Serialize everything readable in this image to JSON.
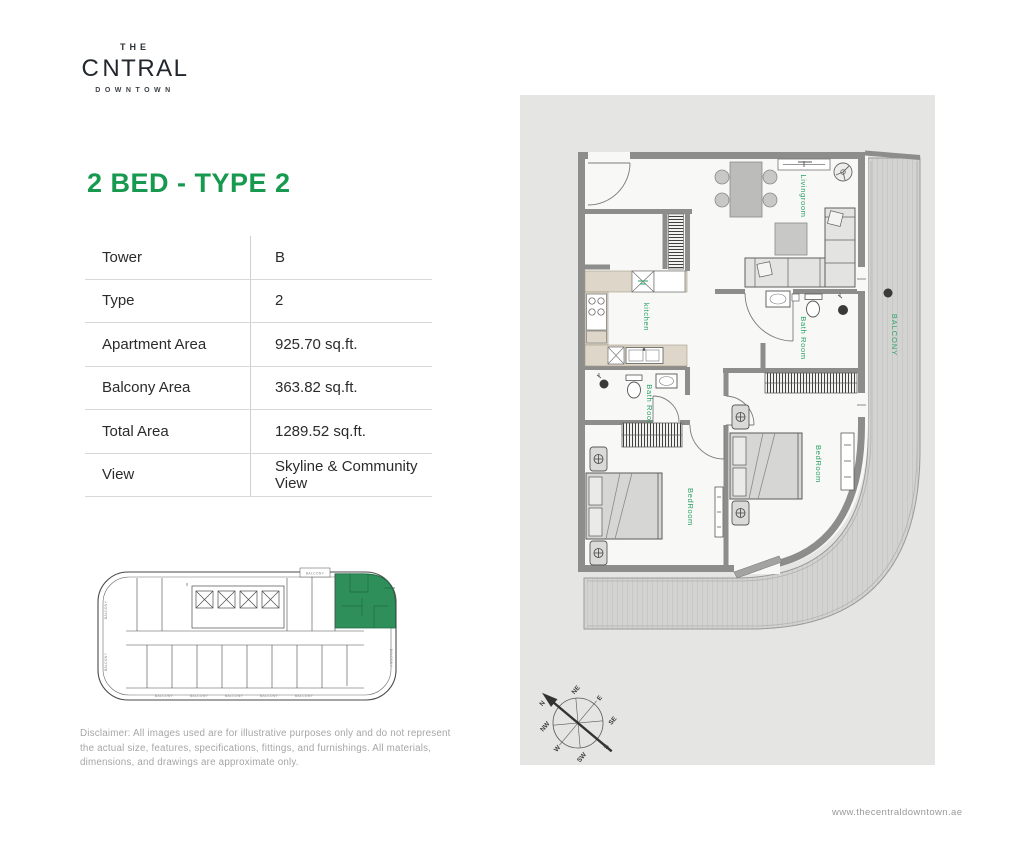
{
  "brand": {
    "line1": "THE",
    "name_c": "C",
    "name_rest": "NTRAL",
    "line3": "DOWNTOWN"
  },
  "page": {
    "title": "2 BED - TYPE 2",
    "website": "www.thecentraldowntown.ae",
    "disclaimer": "Disclaimer: All images used are for illustrative purposes only and do not represent the actual size, features, specifications, fittings, and furnishings. All materials, dimensions, and drawings are approximate only."
  },
  "unit_table": {
    "rows": [
      {
        "label": "Tower",
        "value": "B"
      },
      {
        "label": "Type",
        "value": "2"
      },
      {
        "label": "Apartment Area",
        "value": "925.70 sq.ft."
      },
      {
        "label": "Balcony Area",
        "value": "363.82 sq.ft."
      },
      {
        "label": "Total Area",
        "value": "1289.52 sq.ft."
      },
      {
        "label": "View",
        "value": "Skyline & Community View"
      }
    ]
  },
  "floor_plan": {
    "labels": {
      "livingroom": "Livingroom",
      "kitchen": "kitchen",
      "bath_room": "Bath Room",
      "bed_room": "BedRoom",
      "balcony": "BALCONY"
    }
  },
  "key_plan": {
    "balcony_label": "BALCONY"
  },
  "compass": {
    "points": [
      "N",
      "NE",
      "E",
      "SE",
      "S",
      "SW",
      "W",
      "NW"
    ]
  },
  "colors": {
    "accent_green": "#17994f",
    "label_green": "#2aa065",
    "highlight_green": "#2f8f5b",
    "panel_bg": "#e5e5e3",
    "wall_gray": "#8d8d8b"
  }
}
